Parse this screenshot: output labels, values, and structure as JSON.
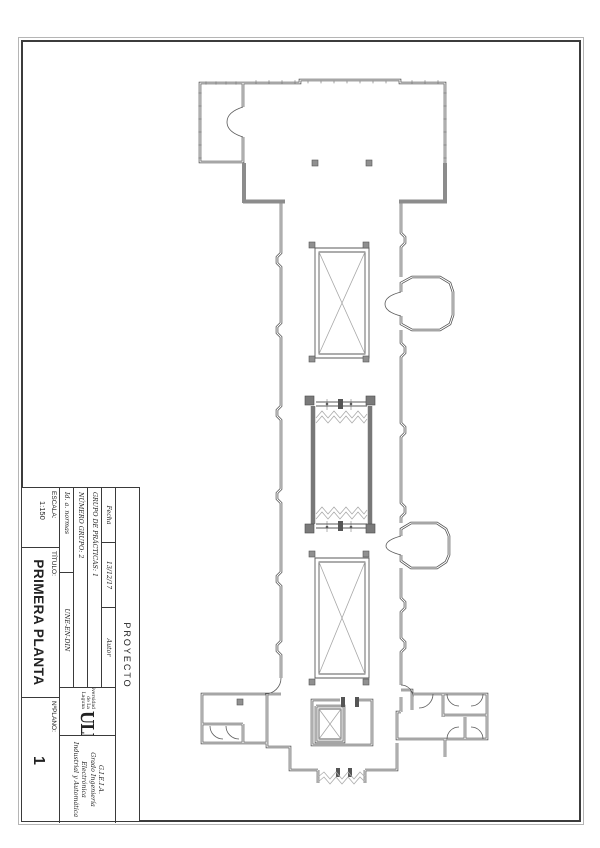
{
  "title_block": {
    "proyecto": "PROYECTO",
    "fecha_label": "Fecha",
    "fecha_value": "13/12/17",
    "autor_label": "Autor",
    "grupo_practicas": "GRUPO DE PRÁCTICAS: 1",
    "numero_grupo": "NÚMERO GRUPO: 2",
    "id_normas_label": "Id. a. normas",
    "id_normas_value": "UNE-EN-DIN",
    "escala_label": "ESCALA:",
    "escala_value": "1:150",
    "titulo_label": "TÍTULO:",
    "titulo_value": "PRIMERA PLANTA",
    "logo_acronym": "ULL",
    "logo_line1": "Universidad",
    "logo_line2": "de La Laguna",
    "degree_line1": "G.I.E.I.A.",
    "degree_line2": "Grado Ingeniería Electrónica",
    "degree_line3": "Industrial y Automática",
    "nplano_label": "NºPLANO:",
    "nplano_value": "1"
  }
}
